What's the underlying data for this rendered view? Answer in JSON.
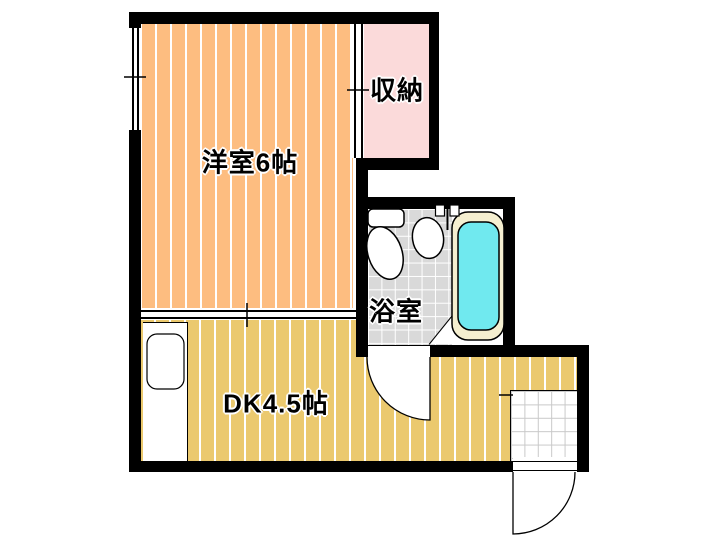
{
  "floorplan": {
    "title": "1DK apartment floor plan",
    "rooms": {
      "western": {
        "label": "洋室6帖",
        "color": "#FDBD80"
      },
      "storage": {
        "label": "収納",
        "color": "#FBDADA"
      },
      "bath": {
        "label": "浴室",
        "color": "#D9D9D9"
      },
      "dk": {
        "label": "DK4.5帖",
        "color": "#EBC96E"
      }
    },
    "fixtures": [
      "bathtub",
      "toilet",
      "wash-basin",
      "faucet",
      "kitchen-sink",
      "entry-door",
      "bath-door",
      "window",
      "genkan-tile"
    ],
    "colors": {
      "wall": "#000000",
      "western_floor": "#FDBD80",
      "dk_floor": "#EBC96E",
      "storage_floor": "#FBDADA",
      "bath_tile": "#D9D9D9",
      "tub_water": "#70E9EF",
      "tub_rim": "#F5EFD0",
      "background": "#FFFFFF"
    }
  }
}
